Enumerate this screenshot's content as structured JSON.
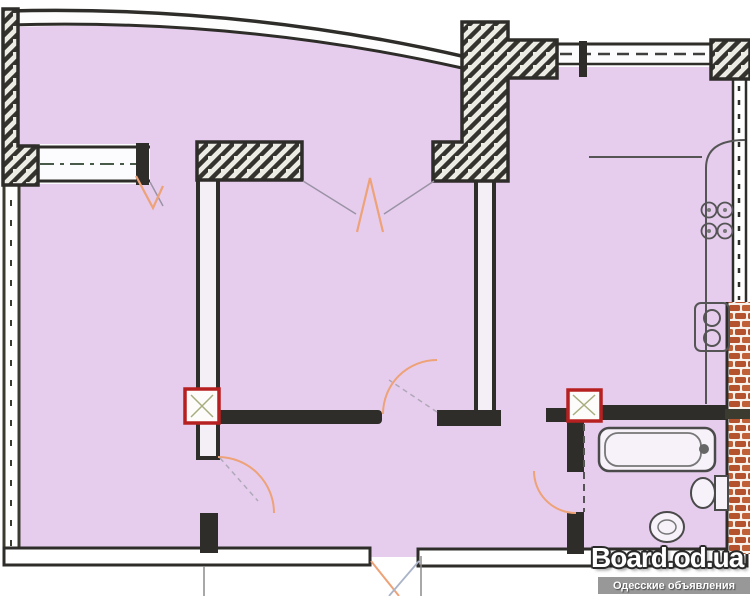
{
  "watermark": {
    "site": "Board.od.ua",
    "tagline": "Одесские объявления"
  },
  "plan": {
    "kind": "apartment-floor-plan",
    "colors": {
      "floor_fill": "#e6cdee",
      "wall": "#2e2d29",
      "wall_olive": "#3c3b2f",
      "hatch_fill": "#edece4",
      "hatch_stroke": "#34332e",
      "brick": "#b5522e",
      "brick_light": "#c06037",
      "marker_red": "#b62020",
      "door_mark_orange": "#eda277",
      "fixture_line": "#555555",
      "window_axis": "#4a5a4a",
      "watermark_bar": "#989898"
    },
    "windows": [
      "left-window",
      "top-window"
    ],
    "piers": [
      "left-pier",
      "pier-a",
      "pier-b",
      "top-right-pier"
    ],
    "fixtures": [
      "kitchen-counter",
      "stove-burners",
      "kitchen-sink",
      "bathtub",
      "toilet",
      "washbasin"
    ],
    "markers": [
      "junction-marker-left",
      "junction-marker-right",
      "opening-zigzag-left",
      "opening-zigzag-center",
      "door-swing-hall",
      "door-swing-bedroom",
      "door-swing-bathroom",
      "entrance-opening-marks"
    ],
    "brick_wall": "right-side-brick-hatch"
  }
}
